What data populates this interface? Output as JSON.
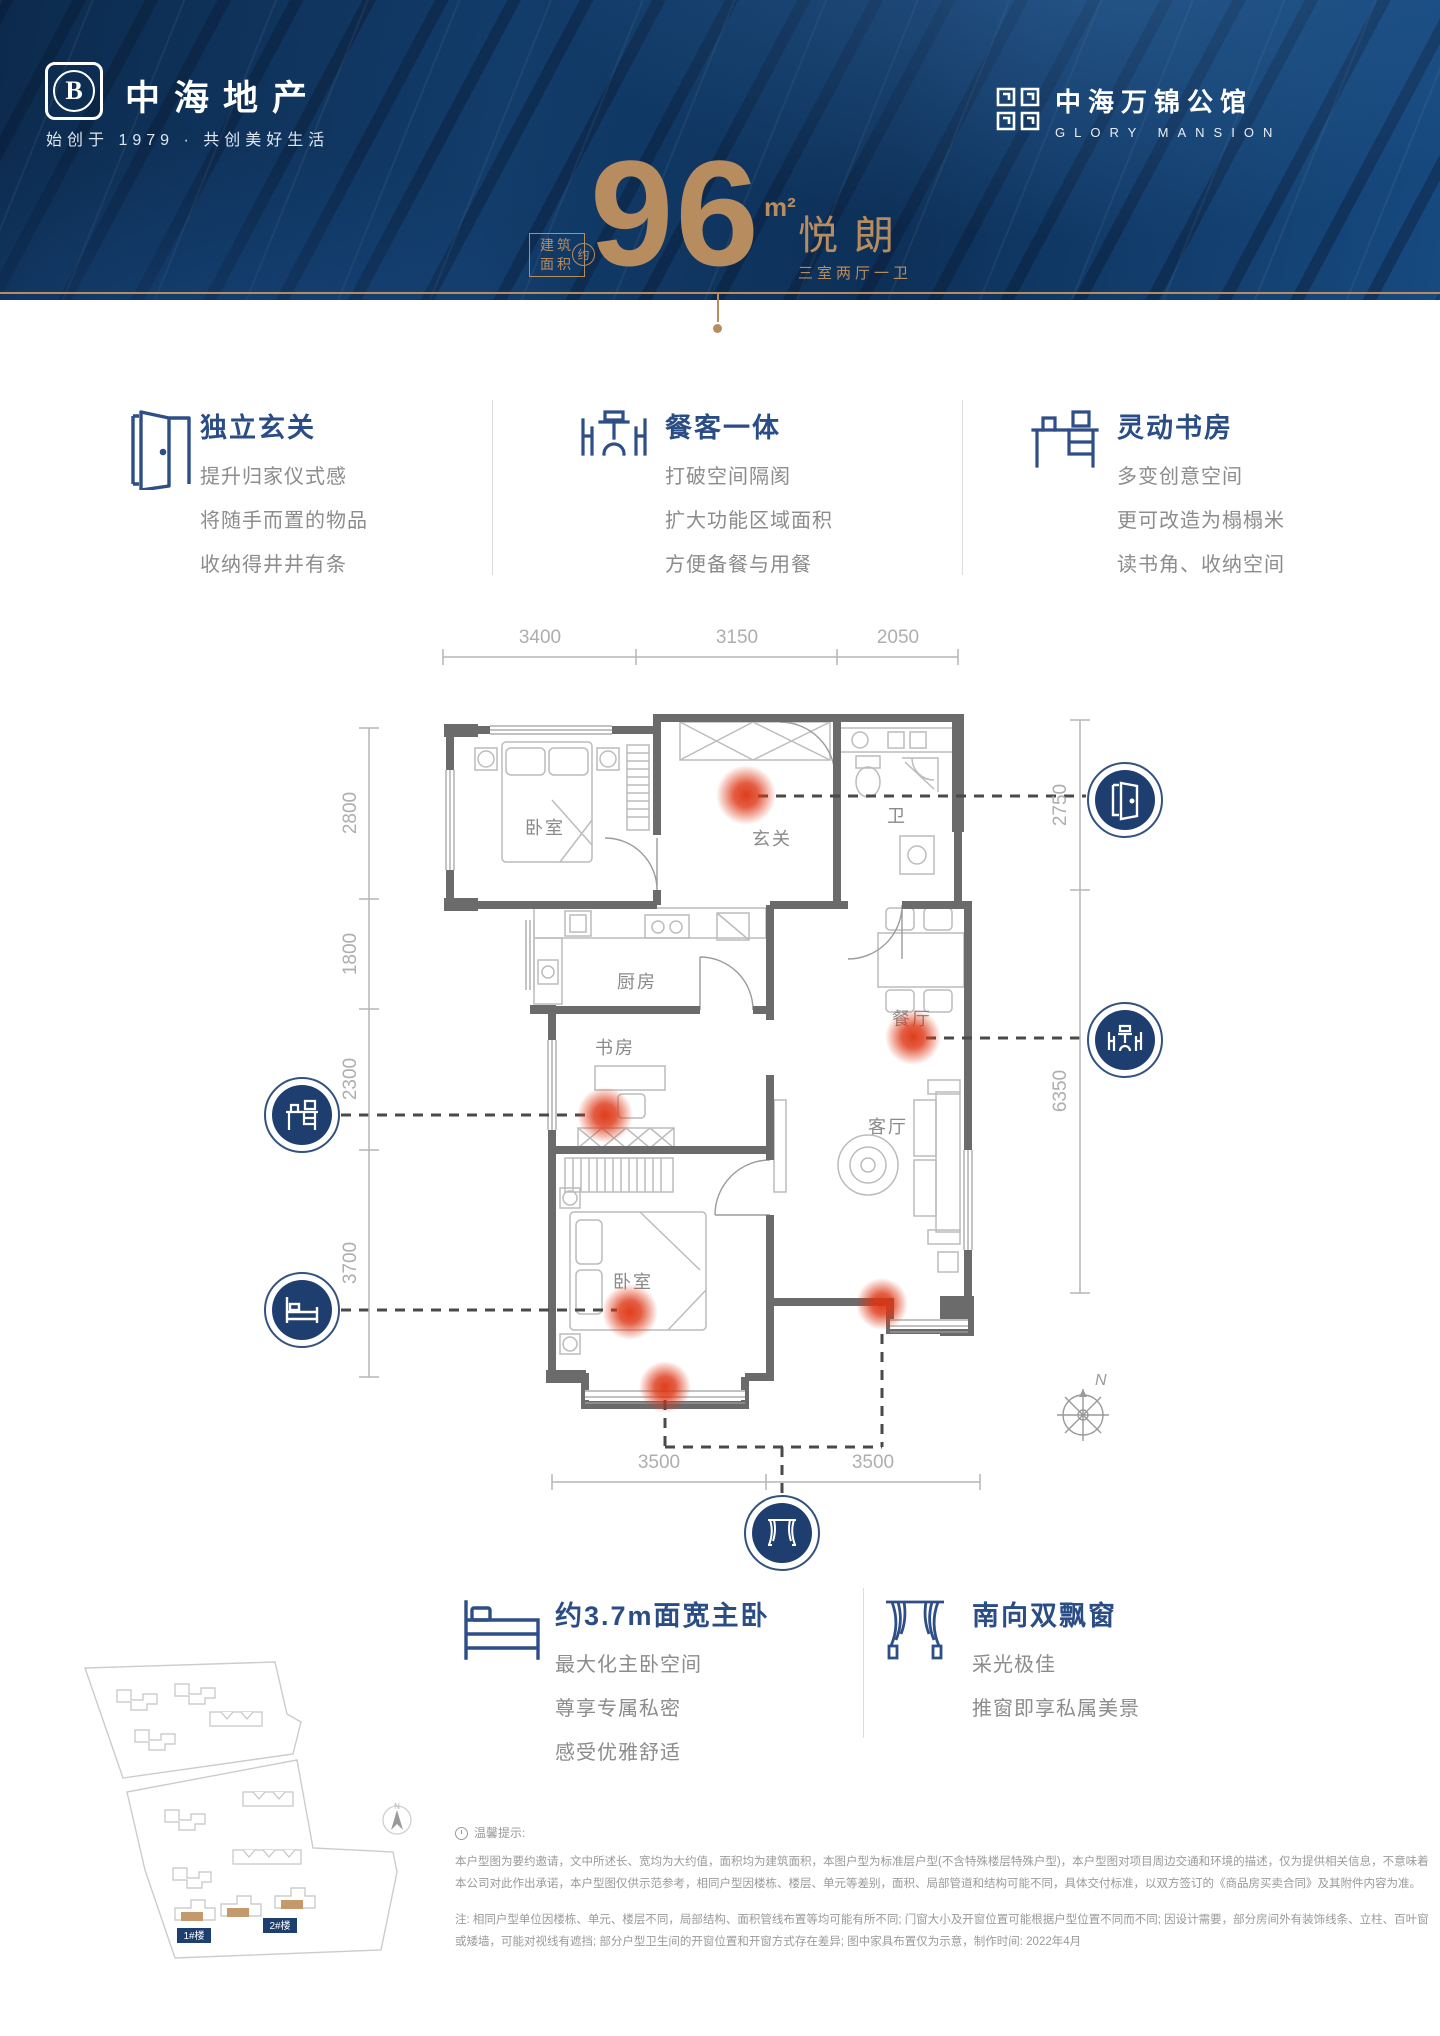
{
  "colors": {
    "hero_navy": "#0d3058",
    "accent_gold": "#b78d60",
    "title_navy": "#2b4d85",
    "icon_navy": "#2d4e86",
    "badge_navy": "#1e3e70",
    "hot_red": "#dd3412",
    "wall_gray": "#6b6b6b"
  },
  "brand": {
    "left": {
      "emblem_letter": "B",
      "name": "中海地产",
      "tagline": "始创于 1979 · 共创美好生活"
    },
    "right": {
      "cn": "中海万锦公馆",
      "en": "GLORY MANSION"
    }
  },
  "headline": {
    "area_label_top": "建筑",
    "area_label_bottom": "面积",
    "approx": "约",
    "area_value": "96",
    "area_unit": "m²",
    "plan_name": "悦朗",
    "plan_layout": "三室两厅一卫"
  },
  "features_top": [
    {
      "icon": "door-icon",
      "title": "独立玄关",
      "lines": [
        "提升归家仪式感",
        "将随手而置的物品",
        "收纳得井井有条"
      ]
    },
    {
      "icon": "dining-icon",
      "title": "餐客一体",
      "lines": [
        "打破空间隔阂",
        "扩大功能区域面积",
        "方便备餐与用餐"
      ]
    },
    {
      "icon": "desk-icon",
      "title": "灵动书房",
      "lines": [
        "多变创意空间",
        "更可改造为榻榻米",
        "读书角、收纳空间"
      ]
    }
  ],
  "floorplan": {
    "rooms": {
      "bedroom1": "卧室",
      "entry": "玄关",
      "bath": "卫",
      "kitchen": "厨房",
      "study": "书房",
      "dining": "餐厅",
      "living": "客厅",
      "master": "卧室"
    },
    "dims_top": [
      "3400",
      "3150",
      "2050"
    ],
    "dims_left": [
      "2800",
      "1800",
      "2300",
      "3700"
    ],
    "dims_right": [
      "2750",
      "6350"
    ],
    "dims_bottom": [
      "3500",
      "3500"
    ],
    "compass": "N",
    "callouts": [
      "door-icon",
      "dining-icon",
      "desk-icon",
      "bed-icon",
      "window-icon"
    ]
  },
  "features_bottom": [
    {
      "icon": "bed-icon",
      "title": "约3.7m面宽主卧",
      "lines": [
        "最大化主卧空间",
        "尊享专属私密",
        "感受优雅舒适"
      ]
    },
    {
      "icon": "curtain-icon",
      "title": "南向双飘窗",
      "lines": [
        "采光极佳",
        "推窗即享私属美景"
      ]
    }
  ],
  "siteplan": {
    "building1": "1#楼",
    "building2": "2#楼",
    "north": "N"
  },
  "disclaimer": {
    "title": "温馨提示:",
    "para1": "本户型图为要约邀请，文中所述长、宽均为大约值，面积均为建筑面积，本图户型为标准层户型(不含特殊楼层特殊户型)，本户型图对项目周边交通和环境的描述，仅为提供相关信息，不意味着本公司对此作出承诺，本户型图仅供示范参考，相同户型因楼栋、楼层、单元等差别，面积、局部管道和结构可能不同，具体交付标准，以双方签订的《商品房买卖合同》及其附件内容为准。",
    "para2": "注: 相同户型单位因楼栋、单元、楼层不同，局部结构、面积管线布置等均可能有所不同; 门窗大小及开窗位置可能根据户型位置不同而不同; 因设计需要，部分房间外有装饰线条、立柱、百叶窗或矮墙，可能对视线有遮挡; 部分户型卫生间的开窗位置和开窗方式存在差异; 图中家具布置仅为示意，制作时间: 2022年4月"
  }
}
